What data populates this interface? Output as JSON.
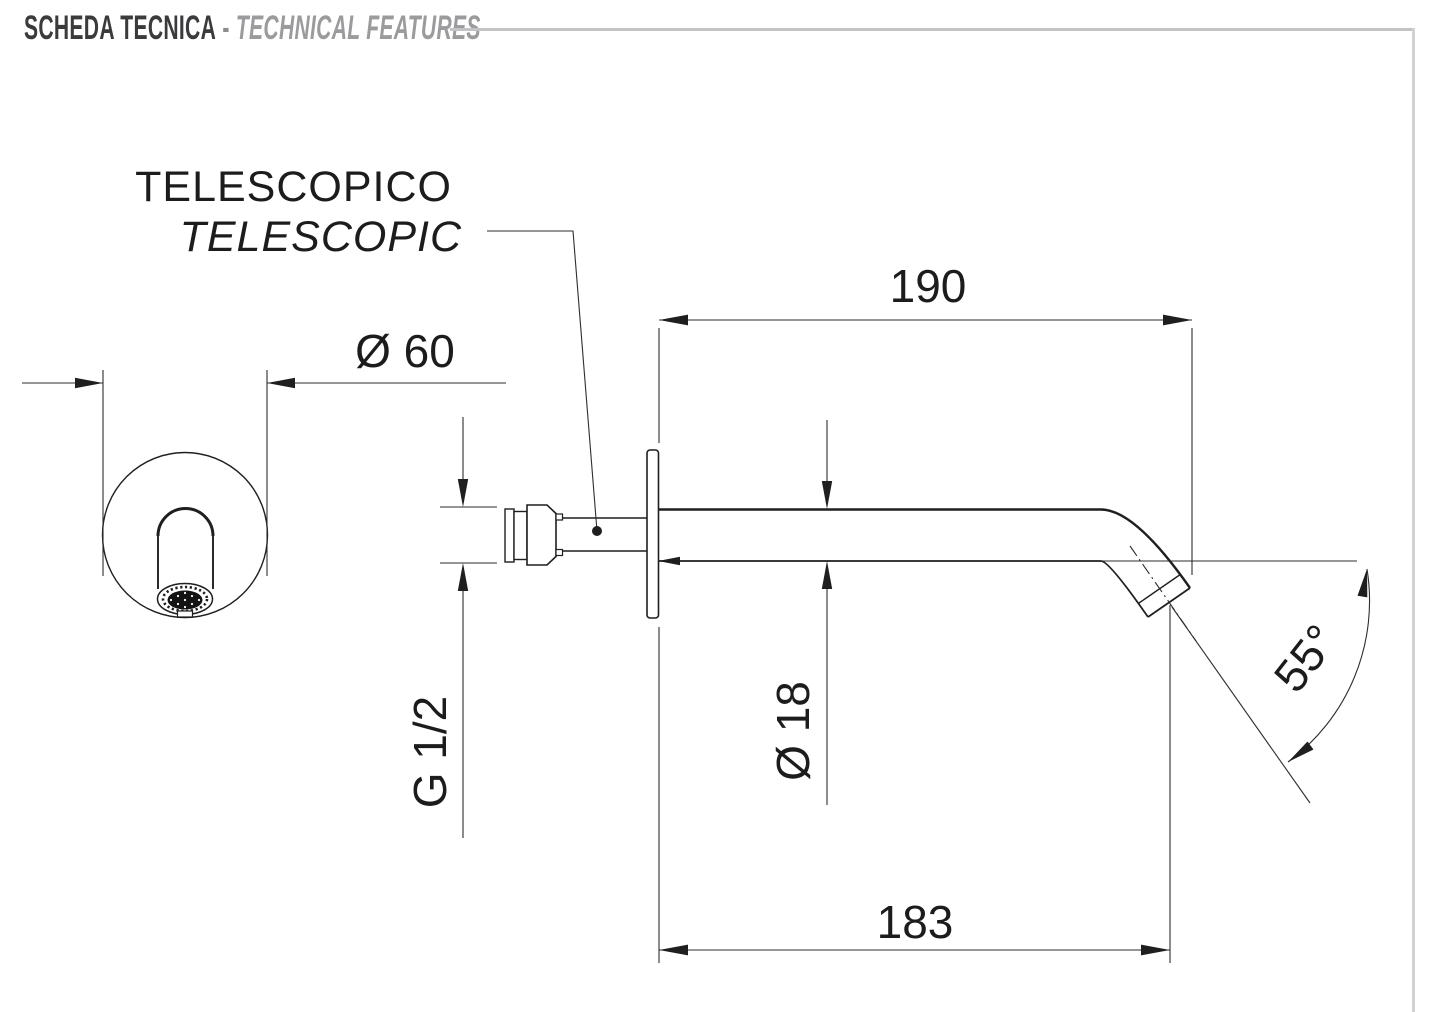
{
  "header": {
    "title_primary": "SCHEDA TECNICA",
    "separator": "-",
    "title_secondary": "TECHNICAL FEATURES"
  },
  "callout": {
    "line1": "TELESCOPICO",
    "line2": "TELESCOPIC"
  },
  "dimensions": {
    "face_diameter": "Ø 60",
    "reach_upper": "190",
    "reach_lower": "183",
    "spout_tube_diameter": "Ø 18",
    "inlet_thread": "G 1/2",
    "outlet_angle": "55°"
  },
  "colors": {
    "line": "#1f1f1f",
    "header_dark": "#3b3b3d",
    "header_gray": "#9b9b9e",
    "rule": "#c3c3c5",
    "page_border": "#d2d2d4"
  }
}
